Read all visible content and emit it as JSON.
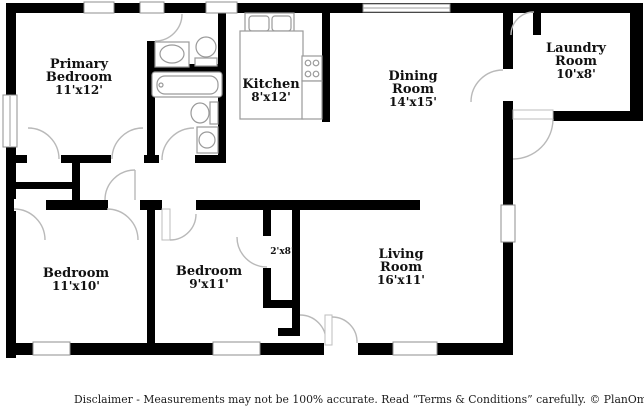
{
  "rooms": {
    "primary_bedroom": {
      "line1": "Primary",
      "line2": "Bedroom",
      "dims": "11'x12'"
    },
    "kitchen": {
      "line1": "Kitchen",
      "dims": "8'x12'"
    },
    "dining_room": {
      "line1": "Dining",
      "line2": "Room",
      "dims": "14'x15'"
    },
    "laundry_room": {
      "line1": "Laundry",
      "line2": "Room",
      "dims": "10'x8'"
    },
    "bedroom_left": {
      "line1": "Bedroom",
      "dims": "11'x10'"
    },
    "bedroom_middle": {
      "line1": "Bedroom",
      "dims": "9'x11'"
    },
    "closet": {
      "dims": "2'x8'"
    },
    "living_room": {
      "line1": "Living",
      "line2": "Room",
      "dims": "16'x11'"
    }
  },
  "footer": {
    "disclaimer": "Disclaimer - Measurements may not be 100% accurate. Read “Terms & Conditions” carefully.",
    "brand": "© PlanOmatic"
  },
  "colors": {
    "wall": "#000000",
    "window_frame": "#8f8f8f",
    "door_arc": "#b9b9b9",
    "fixture_outline": "#9a9a9a",
    "label_text": "#111111"
  }
}
